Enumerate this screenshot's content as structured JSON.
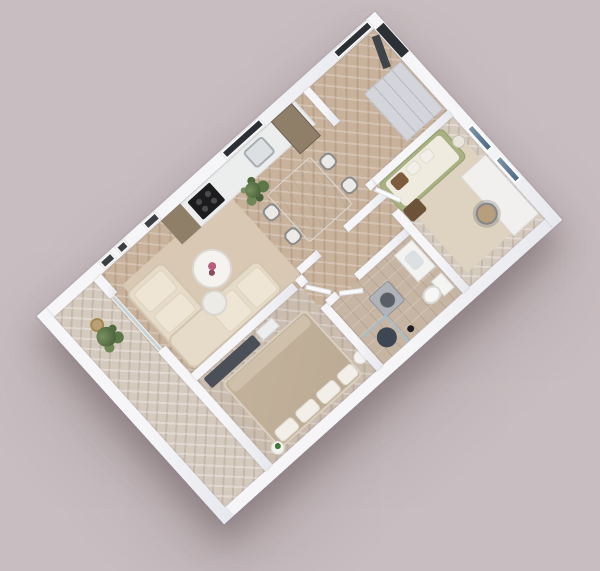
{
  "scene": {
    "type": "3d-floor-plan-render",
    "view": "axonometric-top-down",
    "rotation_deg": -42,
    "visible_text": ""
  },
  "palette": {
    "bg": "#c8bdc0",
    "wall": "#f6f6f8",
    "wall-shade": "#d9dde3",
    "floor-wood": "#c8b29c",
    "floor-wood-grey": "#cabcae",
    "floor-balcony": "#d5cabe",
    "floor-tile": "#c7b5a4",
    "rug-living": "#d8c8b4",
    "rug-office": "#ded2c0",
    "sofa-cream": "#e5dbc8",
    "sofa-cushion": "#eee5d4",
    "daybed-green": "#a9b183",
    "bed-taupe": "#bcab94",
    "dark-furniture": "#4b4f57",
    "window-dark": "#2c2f35",
    "plant-green": "#5e7748",
    "wood-cabinet": "#8f7e68",
    "appliance-grey": "#b0b4b8",
    "shower-mat": "#3d4754",
    "art-blue": "#4a6a85",
    "marble": "#f2f0eb",
    "flower-pink": "#b95f7e"
  },
  "rooms": [
    {
      "name": "balcony",
      "furniture": [
        "potted-plant",
        "basket-pot"
      ]
    },
    {
      "name": "living-room",
      "furniture": [
        "l-shaped-sofa",
        "coffee-table-large",
        "coffee-table-small",
        "area-rug",
        "palm-plant",
        "wall-art-frames"
      ]
    },
    {
      "name": "kitchen",
      "furniture": [
        "counter",
        "cooktop",
        "sink",
        "wood-cabinet",
        "tall-cabinet",
        "window"
      ]
    },
    {
      "name": "dining-area",
      "furniture": [
        "marble-table",
        "chair",
        "chair",
        "chair",
        "chair"
      ]
    },
    {
      "name": "entry-hall",
      "furniture": [
        "front-door",
        "window",
        "wardrobe"
      ]
    },
    {
      "name": "office",
      "furniture": [
        "daybed",
        "throw-pillows",
        "pouf",
        "side-table",
        "desk",
        "office-chair",
        "wall-art",
        "wall-art",
        "rug"
      ]
    },
    {
      "name": "bathroom",
      "furniture": [
        "washing-machine",
        "vanity-sink",
        "toilet",
        "shower-glass",
        "shower-mat",
        "stool"
      ]
    },
    {
      "name": "bedroom",
      "furniture": [
        "double-bed",
        "pillows",
        "tv-console",
        "dresser",
        "nightstand",
        "nightstand-plant"
      ]
    },
    {
      "name": "hallway",
      "furniture": [
        "door",
        "door",
        "door"
      ]
    }
  ]
}
